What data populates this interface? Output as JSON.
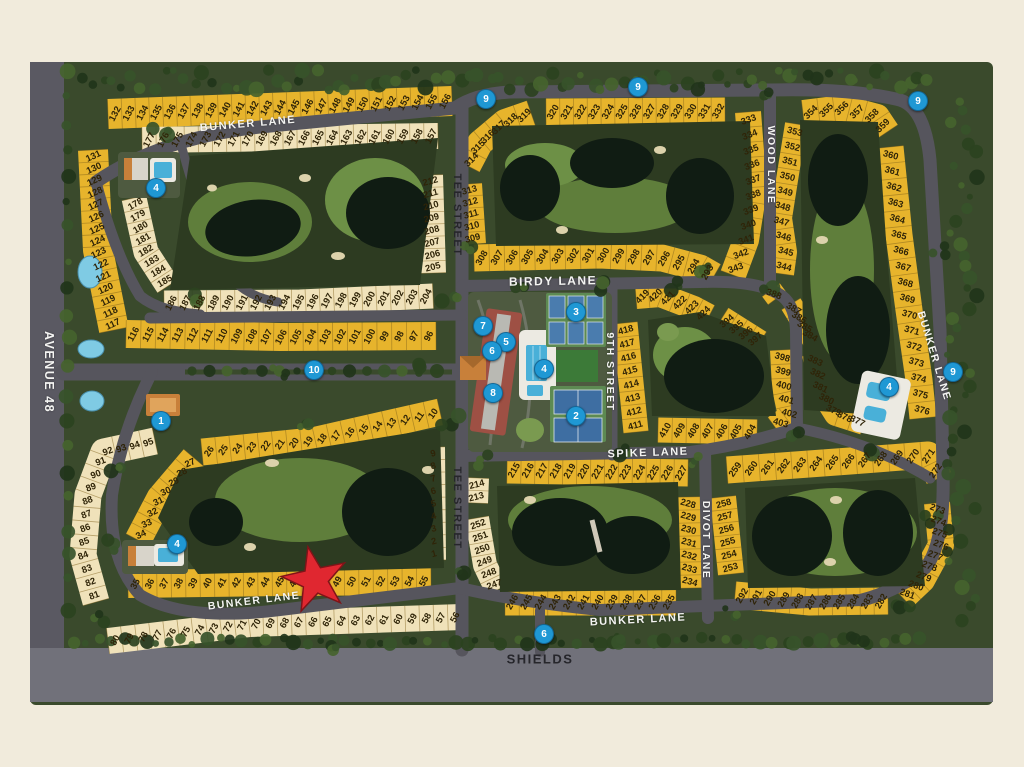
{
  "map_title": "golf community lot plat map",
  "palette": {
    "background": "#f1ebdc",
    "ground": "#3a4a2c",
    "course": "#2d3b21",
    "pond": "#101c13",
    "water_blue": "#5fc0e0",
    "road": "#56555d",
    "shields_road": "#71717a",
    "lot_yellow": "#e7b42c",
    "lot_cream": "#f0e2ba",
    "lot_number_color": "#2f2408",
    "marker_blue": "#1f98d4",
    "star_red": "#e02730"
  },
  "streets": [
    {
      "name": "BUNKER LANE",
      "x": 248,
      "y": 124,
      "rot": -5,
      "tone": "light",
      "fs": 11
    },
    {
      "name": "TEE STREET",
      "x": 457,
      "y": 215,
      "rot": 90,
      "tone": "dark",
      "fs": 11
    },
    {
      "name": "TEE STREET",
      "x": 457,
      "y": 508,
      "rot": 90,
      "tone": "dark",
      "fs": 11
    },
    {
      "name": "BIRDY LANE",
      "x": 553,
      "y": 281,
      "rot": -1,
      "tone": "light",
      "fs": 12
    },
    {
      "name": "WOOD LANE",
      "x": 771,
      "y": 165,
      "rot": 90,
      "tone": "light",
      "fs": 10.5
    },
    {
      "name": "9TH STREET",
      "x": 610,
      "y": 372,
      "rot": 90,
      "tone": "light",
      "fs": 10.5
    },
    {
      "name": "SPIKE LANE",
      "x": 648,
      "y": 453,
      "rot": -2,
      "tone": "light",
      "fs": 11
    },
    {
      "name": "DIVOT LANE",
      "x": 706,
      "y": 540,
      "rot": 90,
      "tone": "light",
      "fs": 10.5
    },
    {
      "name": "BUNKER LANE",
      "x": 934,
      "y": 356,
      "rot": 73,
      "tone": "light",
      "fs": 10.5
    },
    {
      "name": "BUNKER LANE",
      "x": 638,
      "y": 620,
      "rot": -3,
      "tone": "light",
      "fs": 11
    },
    {
      "name": "BUNKER LANE",
      "x": 254,
      "y": 601,
      "rot": -7,
      "tone": "light",
      "fs": 10.5
    },
    {
      "name": "SHIELDS",
      "x": 540,
      "y": 659,
      "rot": 0,
      "tone": "dark",
      "fs": 13
    },
    {
      "name": "AVENUE 48",
      "x": 49,
      "y": 372,
      "rot": 90,
      "tone": "light",
      "fs": 12.5
    }
  ],
  "markers": [
    {
      "label": "1",
      "x": 160,
      "y": 420
    },
    {
      "label": "2",
      "x": 575,
      "y": 415
    },
    {
      "label": "3",
      "x": 575,
      "y": 311
    },
    {
      "label": "4",
      "x": 543,
      "y": 368
    },
    {
      "label": "4",
      "x": 155,
      "y": 187
    },
    {
      "label": "4",
      "x": 176,
      "y": 543
    },
    {
      "label": "4",
      "x": 888,
      "y": 386
    },
    {
      "label": "5",
      "x": 505,
      "y": 341
    },
    {
      "label": "6",
      "x": 491,
      "y": 350
    },
    {
      "label": "7",
      "x": 482,
      "y": 325
    },
    {
      "label": "8",
      "x": 492,
      "y": 392
    },
    {
      "label": "9",
      "x": 485,
      "y": 98
    },
    {
      "label": "9",
      "x": 637,
      "y": 86
    },
    {
      "label": "9",
      "x": 917,
      "y": 100
    },
    {
      "label": "9",
      "x": 952,
      "y": 371
    },
    {
      "label": "10",
      "x": 313,
      "y": 369
    },
    {
      "label": "6",
      "x": 543,
      "y": 633
    }
  ],
  "star": {
    "x": 315,
    "y": 580,
    "rot": -12
  },
  "lot_strips": [
    {
      "id": "lots-132-156",
      "a": 132,
      "b": 156,
      "pts": [
        108,
        114,
        452,
        101
      ],
      "w": 30,
      "rot": -62,
      "f": "y"
    },
    {
      "id": "lots-177-157",
      "a": 177,
      "b": 157,
      "pts": [
        142,
        140,
        438,
        136
      ],
      "w": 26,
      "rot": -62,
      "f": "c"
    },
    {
      "id": "lots-131-117",
      "a": 131,
      "b": 117,
      "pts": [
        93,
        150,
        98,
        250,
        114,
        330
      ],
      "w": 30,
      "rot": -25,
      "f": "y"
    },
    {
      "id": "lots-178-185",
      "a": 178,
      "b": 185,
      "pts": [
        134,
        198,
        146,
        252,
        168,
        286
      ],
      "w": 25,
      "rot": -30,
      "f": "c"
    },
    {
      "id": "lots-186-204",
      "a": 186,
      "b": 204,
      "pts": [
        164,
        303,
        300,
        302,
        433,
        296
      ],
      "w": 25,
      "rot": -62,
      "f": "c"
    },
    {
      "id": "lots-212-205",
      "a": 212,
      "b": 205,
      "pts": [
        430,
        175,
        433,
        273
      ],
      "w": 26,
      "rot": -15,
      "f": "c"
    },
    {
      "id": "lots-116-96",
      "a": 116,
      "b": 96,
      "pts": [
        126,
        334,
        280,
        337,
        436,
        336
      ],
      "w": 28,
      "rot": -62,
      "f": "y"
    },
    {
      "id": "lots-26-10",
      "a": 26,
      "b": 10,
      "pts": [
        202,
        452,
        312,
        441,
        440,
        412
      ],
      "w": 27,
      "rot": -55,
      "f": "y"
    },
    {
      "id": "lots-27-34",
      "a": 27,
      "b": 34,
      "pts": [
        194,
        458,
        160,
        498,
        138,
        540
      ],
      "w": 27,
      "rot": -25,
      "f": "y"
    },
    {
      "id": "lots-35-55",
      "a": 35,
      "b": 55,
      "pts": [
        128,
        584,
        280,
        582,
        431,
        581
      ],
      "w": 28,
      "rot": -62,
      "f": "y"
    },
    {
      "id": "lots-80-56",
      "a": 80,
      "b": 56,
      "pts": [
        108,
        641,
        250,
        624,
        462,
        617
      ],
      "w": 26,
      "rot": -62,
      "f": "c"
    },
    {
      "id": "lots-81-95",
      "a": 81,
      "b": 95,
      "pts": [
        96,
        602,
        83,
        555,
        88,
        495,
        104,
        452,
        155,
        441
      ],
      "w": 27,
      "rot": -20,
      "f": "c"
    },
    {
      "id": "lots-9-1",
      "a": 9,
      "b": 1,
      "pts": [
        433,
        447,
        434,
        560
      ],
      "w": 24,
      "rot": -15,
      "f": "c"
    },
    {
      "id": "lots-214-213",
      "a": 214,
      "b": 213,
      "pts": [
        477,
        478,
        476,
        503
      ],
      "w": 24,
      "rot": -15,
      "f": "c"
    },
    {
      "id": "lots-252-247",
      "a": 252,
      "b": 247,
      "pts": [
        477,
        518,
        485,
        565,
        497,
        590
      ],
      "w": 24,
      "rot": -20,
      "f": "c"
    },
    {
      "id": "lots-215-227",
      "a": 215,
      "b": 227,
      "pts": [
        507,
        470,
        688,
        473
      ],
      "w": 27,
      "rot": -60,
      "f": "y"
    },
    {
      "id": "lots-228-234",
      "a": 228,
      "b": 234,
      "pts": [
        688,
        497,
        690,
        588
      ],
      "w": 26,
      "rot": 15,
      "f": "y"
    },
    {
      "id": "lots-246-235",
      "a": 246,
      "b": 235,
      "pts": [
        505,
        602,
        676,
        602
      ],
      "w": 27,
      "rot": -60,
      "f": "y"
    },
    {
      "id": "lots-258-253",
      "a": 258,
      "b": 253,
      "pts": [
        723,
        497,
        731,
        574
      ],
      "w": 26,
      "rot": -15,
      "f": "y"
    },
    {
      "id": "lots-259-272",
      "a": 259,
      "b": 272,
      "pts": [
        727,
        470,
        850,
        461,
        928,
        455,
        939,
        478
      ],
      "w": 27,
      "rot": -55,
      "f": "y"
    },
    {
      "id": "lots-273-281",
      "a": 273,
      "b": 281,
      "pts": [
        937,
        503,
        941,
        545,
        922,
        580,
        903,
        598
      ],
      "w": 26,
      "rot": 20,
      "f": "y"
    },
    {
      "id": "lots-292-282",
      "a": 292,
      "b": 282,
      "pts": [
        735,
        595,
        810,
        602,
        888,
        601
      ],
      "w": 27,
      "rot": -60,
      "f": "y"
    },
    {
      "id": "lots-308-293",
      "a": 308,
      "b": 293,
      "pts": [
        474,
        258,
        600,
        255,
        662,
        258,
        700,
        268,
        714,
        276
      ],
      "w": 27,
      "rot": -60,
      "f": "y"
    },
    {
      "id": "lots-313-309",
      "a": 313,
      "b": 309,
      "pts": [
        469,
        184,
        473,
        244
      ],
      "w": 26,
      "rot": -15,
      "f": "y"
    },
    {
      "id": "lots-314-319",
      "a": 314,
      "b": 319,
      "pts": [
        468,
        166,
        480,
        143,
        505,
        122,
        531,
        113
      ],
      "w": 26,
      "rot": -45,
      "f": "y"
    },
    {
      "id": "lots-320-332",
      "a": 320,
      "b": 332,
      "pts": [
        546,
        112,
        725,
        111
      ],
      "w": 27,
      "rot": -60,
      "f": "y"
    },
    {
      "id": "lots-333-343",
      "a": 333,
      "b": 343,
      "pts": [
        748,
        112,
        754,
        190,
        746,
        240,
        733,
        275
      ],
      "w": 26,
      "rot": -20,
      "f": "y"
    },
    {
      "id": "lots-353-344",
      "a": 353,
      "b": 344,
      "pts": [
        796,
        124,
        787,
        180,
        781,
        218,
        786,
        252,
        783,
        274
      ],
      "w": 22,
      "rot": 15,
      "f": "y"
    },
    {
      "id": "lots-354-359",
      "a": 354,
      "b": 359,
      "pts": [
        803,
        113,
        843,
        108,
        877,
        117,
        887,
        132
      ],
      "w": 26,
      "rot": -45,
      "f": "y"
    },
    {
      "id": "lots-360-376",
      "a": 360,
      "b": 376,
      "pts": [
        890,
        147,
        899,
        235,
        909,
        310,
        919,
        380,
        923,
        418
      ],
      "w": 27,
      "rot": 15,
      "f": "y"
    },
    {
      "id": "lots-383-377",
      "a": 383,
      "b": 377,
      "pts": [
        814,
        354,
        821,
        390,
        836,
        414,
        864,
        423
      ],
      "w": 24,
      "rot": 25,
      "f": "y"
    },
    {
      "id": "lots-387-384",
      "a": 387,
      "b": 384,
      "pts": [
        791,
        304,
        813,
        340
      ],
      "w": 22,
      "rot": 30,
      "f": "y"
    },
    {
      "id": "lot-388",
      "a": 388,
      "b": 388,
      "pts": [
        771,
        290,
        777,
        298
      ],
      "w": 22,
      "rot": 20,
      "f": "y"
    },
    {
      "id": "lots-394-397",
      "a": 394,
      "b": 397,
      "pts": [
        722,
        318,
        760,
        342
      ],
      "w": 24,
      "rot": -40,
      "f": "y"
    },
    {
      "id": "lots-398-403",
      "a": 398,
      "b": 403,
      "pts": [
        782,
        350,
        784,
        388,
        790,
        416,
        775,
        427
      ],
      "w": 24,
      "rot": 15,
      "f": "y"
    },
    {
      "id": "lots-410-404",
      "a": 410,
      "b": 404,
      "pts": [
        658,
        430,
        757,
        432
      ],
      "w": 25,
      "rot": -60,
      "f": "y"
    },
    {
      "id": "lots-418-411",
      "a": 418,
      "b": 411,
      "pts": [
        625,
        323,
        636,
        432
      ],
      "w": 25,
      "rot": -15,
      "f": "y"
    },
    {
      "id": "lots-419-424",
      "a": 419,
      "b": 424,
      "pts": [
        636,
        297,
        660,
        295,
        694,
        308,
        709,
        316
      ],
      "w": 24,
      "rot": -45,
      "f": "y"
    }
  ]
}
